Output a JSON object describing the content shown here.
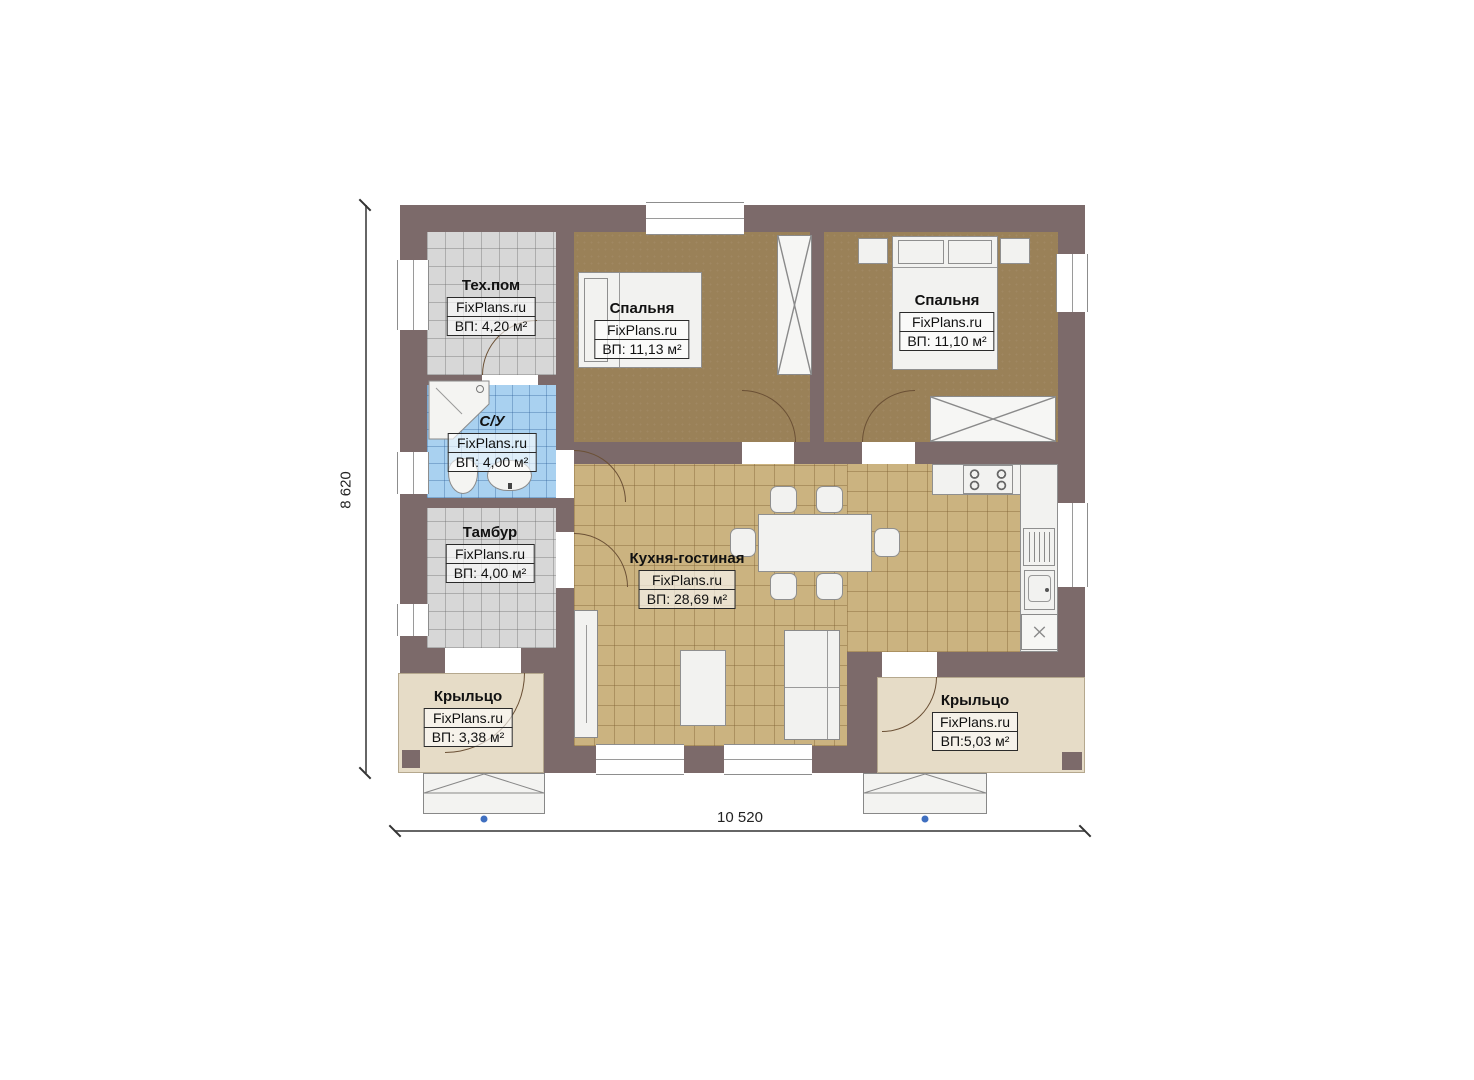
{
  "plan": {
    "watermark": "FixPlans.ru",
    "dimensions": {
      "width_mm": "10 520",
      "height_mm": "8 620"
    }
  },
  "rooms": [
    {
      "key": "tech-room",
      "name": "Тех.пом",
      "brand": "FixPlans.ru",
      "area": "ВП: 4,20 м²"
    },
    {
      "key": "bedroom-1",
      "name": "Спальня",
      "brand": "FixPlans.ru",
      "area": "ВП: 11,13 м²"
    },
    {
      "key": "bedroom-2",
      "name": "Спальня",
      "brand": "FixPlans.ru",
      "area": "ВП: 11,10 м²"
    },
    {
      "key": "bathroom",
      "name": "С/У",
      "brand": "FixPlans.ru",
      "area": "ВП: 4,00 м²"
    },
    {
      "key": "vestibule",
      "name": "Тамбур",
      "brand": "FixPlans.ru",
      "area": "ВП: 4,00 м²"
    },
    {
      "key": "kitchen-living",
      "name": "Кухня-гостиная",
      "brand": "FixPlans.ru",
      "area": "ВП: 28,69 м²"
    },
    {
      "key": "porch-left",
      "name": "Крыльцо",
      "brand": "FixPlans.ru",
      "area": "ВП: 3,38 м²"
    },
    {
      "key": "porch-right",
      "name": "Крыльцо",
      "brand": "FixPlans.ru",
      "area": "ВП:5,03 м²"
    }
  ],
  "colors": {
    "wall": "#7c6a6a",
    "bedroom_floor": "#9a8158",
    "kitchen_floor": "#cbb380",
    "tile_gray": "#d7d7d7",
    "tile_blue": "#a9d1f0",
    "porch": "#e6dcc7",
    "furniture": "#f2f2f0",
    "door_arc": "#6b5035",
    "step_marker": "#3f6fc0"
  }
}
